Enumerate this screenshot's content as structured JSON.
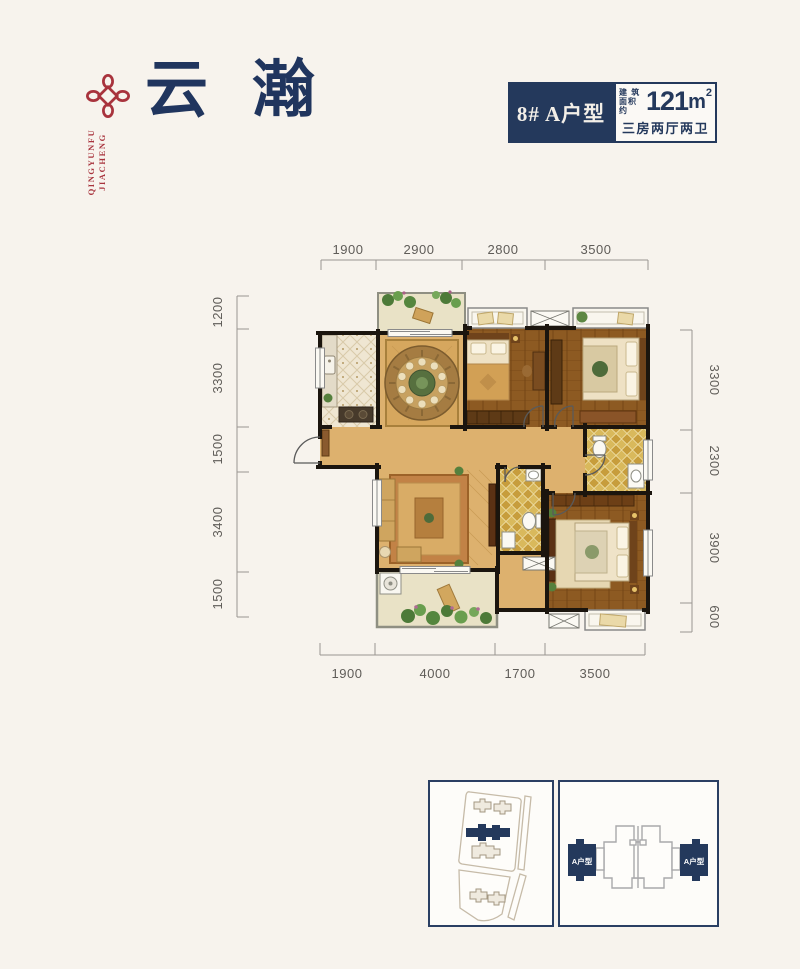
{
  "page": {
    "background": "#f7f3ed"
  },
  "brand": {
    "logo_icon": "chinese-knot-icon",
    "logo_color": "#a8333d",
    "name_line1": "JIACHENG",
    "name_line2": "QINGYUNFU",
    "title": "云瀚",
    "title_color": "#20355e"
  },
  "unit_info": {
    "unit_label": "8# A户型",
    "area_label_top": "建 筑",
    "area_label_bottom": "面积约",
    "area_value": "121",
    "area_unit": "m",
    "area_exponent": "2",
    "layout_label": "三房两厅两卫",
    "accent_navy": "#24395c"
  },
  "floorplan": {
    "dims_top": [
      "1900",
      "2900",
      "2800",
      "3500"
    ],
    "dims_bottom": [
      "1900",
      "4000",
      "1700",
      "3500"
    ],
    "dims_left": [
      "1200",
      "3300",
      "1500",
      "3400",
      "1500"
    ],
    "dims_right": [
      "3300",
      "2300",
      "3900",
      "600"
    ]
  },
  "footer": {
    "site_plan": {
      "highlight_color": "#24395c"
    },
    "key_plate": {
      "left_unit_label": "A户型",
      "right_unit_label": "A户型"
    }
  }
}
